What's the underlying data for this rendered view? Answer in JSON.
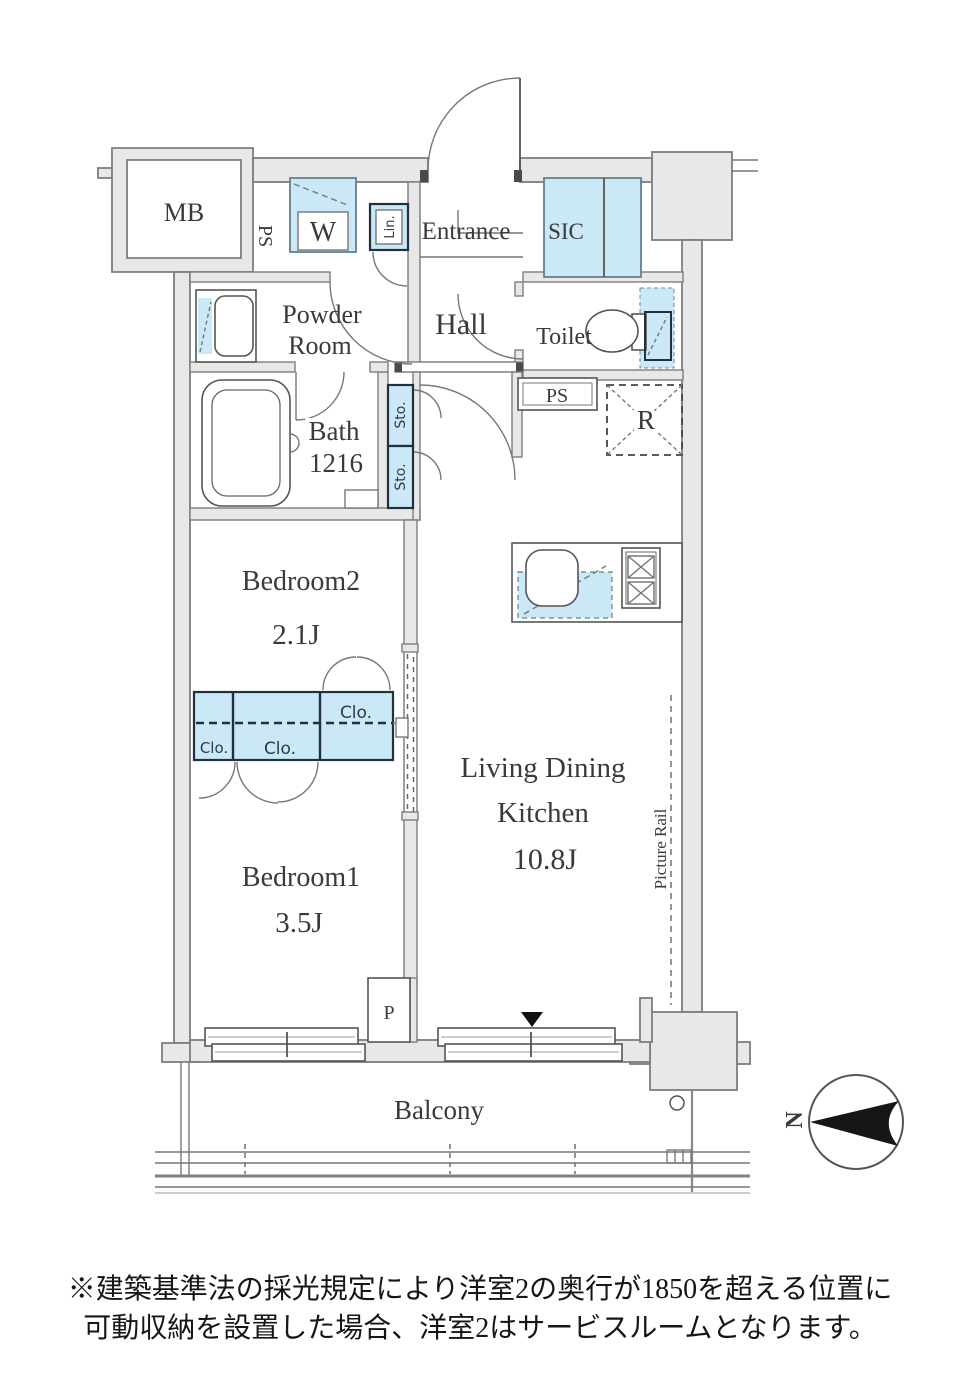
{
  "floorplan": {
    "labels": {
      "mb": "MB",
      "ps_shaft": "PS",
      "washer": "W",
      "linen": "Lin.",
      "entrance": "Entrance",
      "sic": "SIC",
      "powder_room": [
        "Powder",
        "Room"
      ],
      "hall": "Hall",
      "toilet": "Toilet",
      "bath": [
        "Bath",
        "1216"
      ],
      "storages": [
        "Sto.",
        "Sto."
      ],
      "ps_duct": "PS",
      "refrigerator": "R",
      "bedroom2": "Bedroom2",
      "bedroom2_size": "2.1J",
      "closets": [
        "Clo.",
        "Clo.",
        "Clo."
      ],
      "ldk": [
        "Living Dining",
        "Kitchen"
      ],
      "ldk_size": "10.8J",
      "picture_rail": "Picture Rail",
      "bedroom1": "Bedroom1",
      "bedroom1_size": "3.5J",
      "pipe_space": "P",
      "balcony": "Balcony"
    },
    "compass": {
      "north": "N"
    },
    "note": {
      "line1": "※建築基準法の採光規定により洋室2の奥行が1850を超える位置に",
      "line2": "可動収納を設置した場合、洋室2はサービスルームとなります。"
    },
    "colors": {
      "fixture_blue": "#cbe8f6",
      "wall_fill": "#e8e8e8",
      "wall_stroke": "#7d7d7d",
      "dark_border": "#22303e",
      "text": "#3a3a3a"
    }
  }
}
